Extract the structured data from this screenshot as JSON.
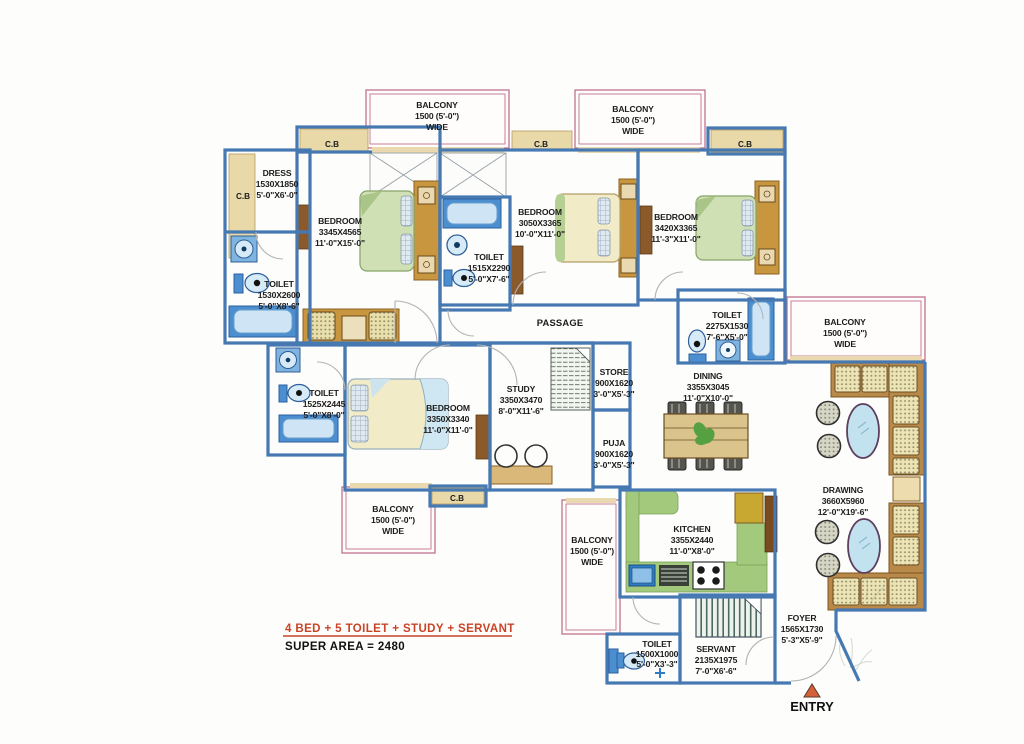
{
  "footer": {
    "summary": "4 BED + 5 TOILET  + STUDY + SERVANT",
    "super_area": "SUPER AREA = 2480"
  },
  "entry_label": "ENTRY",
  "passage_label": "PASSAGE",
  "cupboard_label": "C.B",
  "colors": {
    "wall_blue": "#4678b2",
    "balcony_outline_pink": "#c2728f",
    "accent_red": "#c94327",
    "wood_tan": "#c8963f",
    "kitchen_green": "#a3c97c",
    "fixture_blue": "#5b9bd5"
  },
  "rooms": {
    "bedroom1": {
      "name": "BEDROOM",
      "size_mm": "3345X4565",
      "size_ft": "11'-0\"X15'-0\""
    },
    "bedroom2": {
      "name": "BEDROOM",
      "size_mm": "3050X3365",
      "size_ft": "10'-0\"X11'-0\""
    },
    "bedroom3": {
      "name": "BEDROOM",
      "size_mm": "3420X3365",
      "size_ft": "11'-3\"X11'-0\""
    },
    "bedroom4": {
      "name": "BEDROOM",
      "size_mm": "3350X3340",
      "size_ft": "11'-0\"X11'-0\""
    },
    "dress": {
      "name": "DRESS",
      "size_mm": "1530X1850",
      "size_ft": "5'-0\"X6'-0\""
    },
    "toilet1": {
      "name": "TOILET",
      "size_mm": "1530X2600",
      "size_ft": "5'-0\"X8'-6\""
    },
    "toilet2": {
      "name": "TOILET",
      "size_mm": "1515X2290",
      "size_ft": "5'-0\"X7'-6\""
    },
    "toilet3": {
      "name": "TOILET",
      "size_mm": "2275X1530",
      "size_ft": "7'-6\"X5'-0\""
    },
    "toilet4": {
      "name": "TOILET",
      "size_mm": "1525X2445",
      "size_ft": "5'-0\"X8'-0\""
    },
    "toilet5": {
      "name": "TOILET",
      "size_mm": "1500X1000",
      "size_ft": "5'-0\"X3'-3\""
    },
    "study": {
      "name": "STUDY",
      "size_mm": "3350X3470",
      "size_ft": "8'-0\"X11'-6\""
    },
    "store": {
      "name": "STORE",
      "size_mm": "900X1620",
      "size_ft": "3'-0\"X5'-3\""
    },
    "puja": {
      "name": "PUJA",
      "size_mm": "900X1620",
      "size_ft": "3'-0\"X5'-3\""
    },
    "dining": {
      "name": "DINING",
      "size_mm": "3355X3045",
      "size_ft": "11'-0\"X10'-0\""
    },
    "kitchen": {
      "name": "KITCHEN",
      "size_mm": "3355X2440",
      "size_ft": "11'-0\"X8'-0\""
    },
    "drawing": {
      "name": "DRAWING",
      "size_mm": "3660X5960",
      "size_ft": "12'-0\"X19'-6\""
    },
    "servant": {
      "name": "SERVANT",
      "size_mm": "2135X1975",
      "size_ft": "7'-0\"X6'-6\""
    },
    "foyer": {
      "name": "FOYER",
      "size_mm": "1565X1730",
      "size_ft": "5'-3\"X5'-9\""
    },
    "balcony_top_left": {
      "name": "BALCONY",
      "size_mm": "1500 (5'-0\")",
      "size_ft": "WIDE"
    },
    "balcony_top_middle": {
      "name": "BALCONY",
      "size_mm": "1500 (5'-0\")",
      "size_ft": "WIDE"
    },
    "balcony_right": {
      "name": "BALCONY",
      "size_mm": "1500 (5'-0\")",
      "size_ft": "WIDE"
    },
    "balcony_bottom_left": {
      "name": "BALCONY",
      "size_mm": "1500 (5'-0\")",
      "size_ft": "WIDE"
    },
    "balcony_bottom_middle": {
      "name": "BALCONY",
      "size_mm": "1500 (5'-0\")",
      "size_ft": "WIDE"
    }
  }
}
